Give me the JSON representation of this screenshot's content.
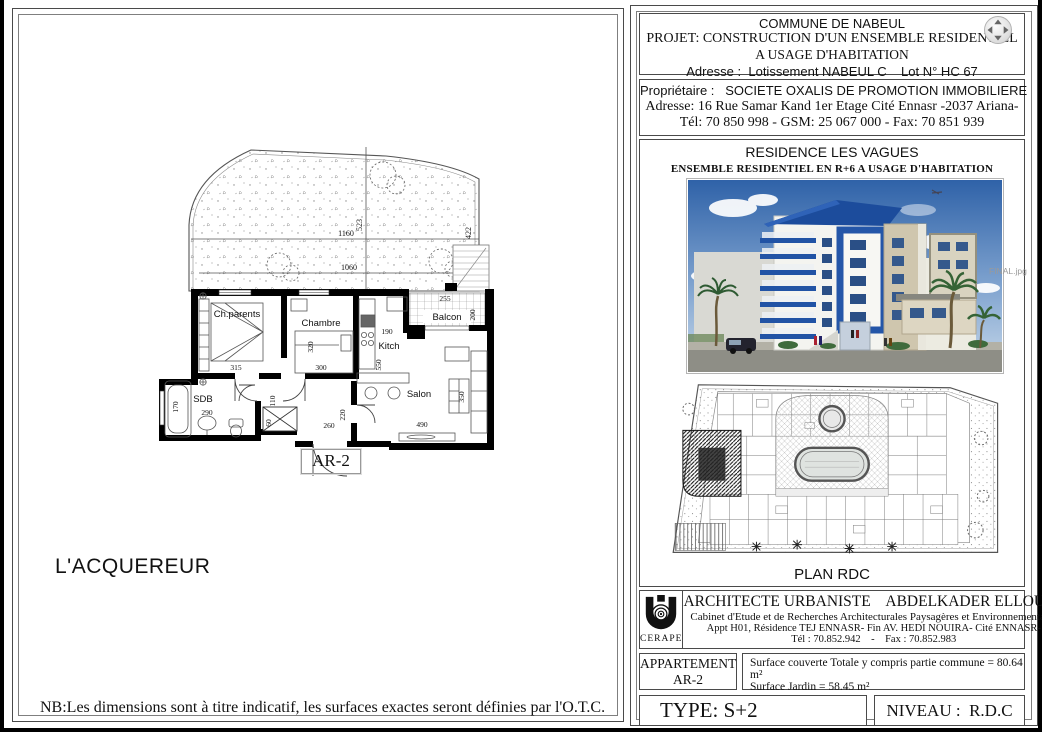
{
  "page": {
    "plan": {
      "label": "AR-2",
      "acquirer": "L'ACQUEREUR",
      "note": "NB:Les dimensions sont à titre indicatif, les surfaces exactes seront définies par l'O.T.C.",
      "rooms": {
        "parents": "Ch.parents",
        "chambre": "Chambre",
        "kitchen": "Kitch",
        "balcony": "Balcon",
        "salon": "Salon",
        "bath": "SDB"
      },
      "dims": {
        "d1160": "1160",
        "d523": "523",
        "d1060": "1060",
        "d422": "422",
        "d255": "255",
        "d200": "200",
        "d190": "190",
        "d550": "550",
        "d315": "315",
        "d320": "320",
        "d300": "300",
        "d110": "110",
        "d220": "220",
        "d260": "260",
        "d60": "60",
        "d290": "290",
        "d170": "170",
        "d490": "490",
        "d350": "350"
      }
    },
    "title_block": {
      "commune": "COMMUNE DE NABEUL",
      "project_line1": "PROJET: CONSTRUCTION D'UN ENSEMBLE RESIDENTIEL",
      "project_line2": "A USAGE D'HABITATION",
      "address": "Adresse :  Lotissement NABEUL C    Lot N° HC 67",
      "owner_label": "Propriétaire :   SOCIETE OXALIS DE PROMOTION IMMOBILIERE",
      "owner_address": "Adresse: 16 Rue Samar Kand 1er Etage Cité Ennasr -2037 Ariana-",
      "owner_phone": "Tél: 70 850 998 - GSM: 25 067 000 - Fax: 70 851 939",
      "residence_title": "RESIDENCE LES VAGUES",
      "residence_subtitle": "ENSEMBLE RESIDENTIEL  EN R+6  A USAGE D'HABITATION",
      "render_filename": "FINAL.jpg",
      "siteplan_caption": "PLAN RDC",
      "architect": {
        "logo": "CERAPE",
        "line1": "ARCHITECTE URBANISTE    ABDELKADER ELLOUZE",
        "line2": "Cabinet d'Etude et de Recherches Architecturales Paysagères  et Environnementales",
        "line3": "Appt H01, Résidence TEJ ENNASR- Fin AV. HEDI NOUIRA-  Cité ENNASR-",
        "line4": "Tél : 70.852.942    -    Fax : 70.852.983"
      },
      "apartment_label1": "APPARTEMENT",
      "apartment_label2": "AR-2",
      "surface_line1": "Surface couverte Totale y compris partie commune = 80.64 m²",
      "surface_line2": "Surface Jardin = 58.45 m²",
      "type_label": "TYPE: S+2",
      "level_label": "NIVEAU :  R.D.C"
    },
    "colors": {
      "accent_blue": "#2456a8",
      "roof_blue": "#1d4f9e",
      "beige": "#cfc6ae",
      "sky": "#2f62a8"
    }
  }
}
